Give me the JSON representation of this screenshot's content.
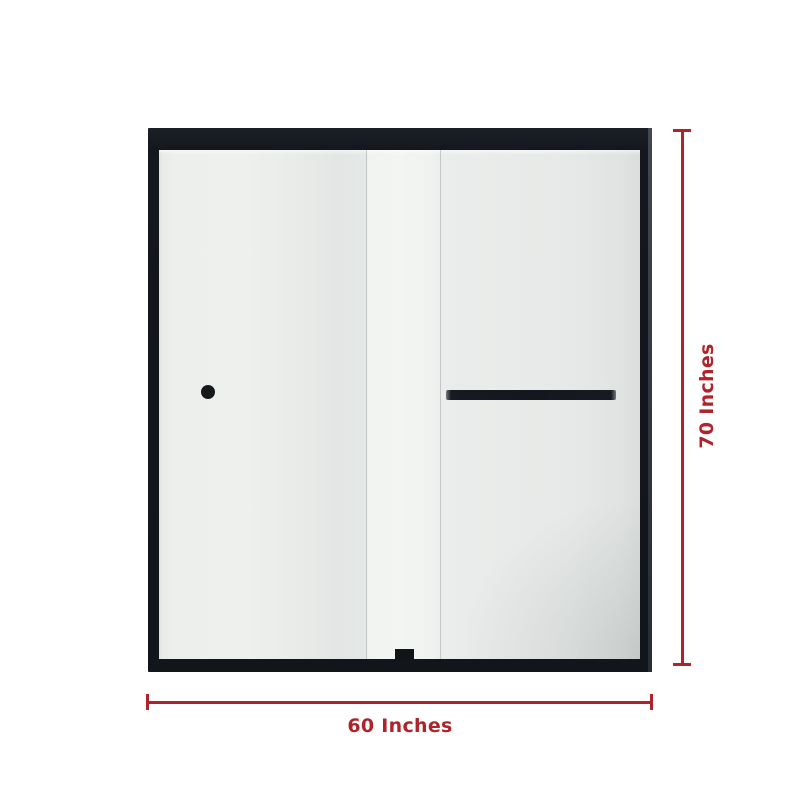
{
  "theme": {
    "bg": "#ffffff",
    "accent": "#b1232a",
    "frame": "#14171d",
    "glass": "#eaedeb"
  },
  "diagram": {
    "type": "product-dimension-diagram",
    "subject": "framed sliding glass shower door",
    "width_label": "60 Inches",
    "height_label": "70 Inches",
    "parts": {
      "knob": "door-knob",
      "bar": "towel-bar-handle",
      "guide": "bottom-door-guide"
    }
  }
}
